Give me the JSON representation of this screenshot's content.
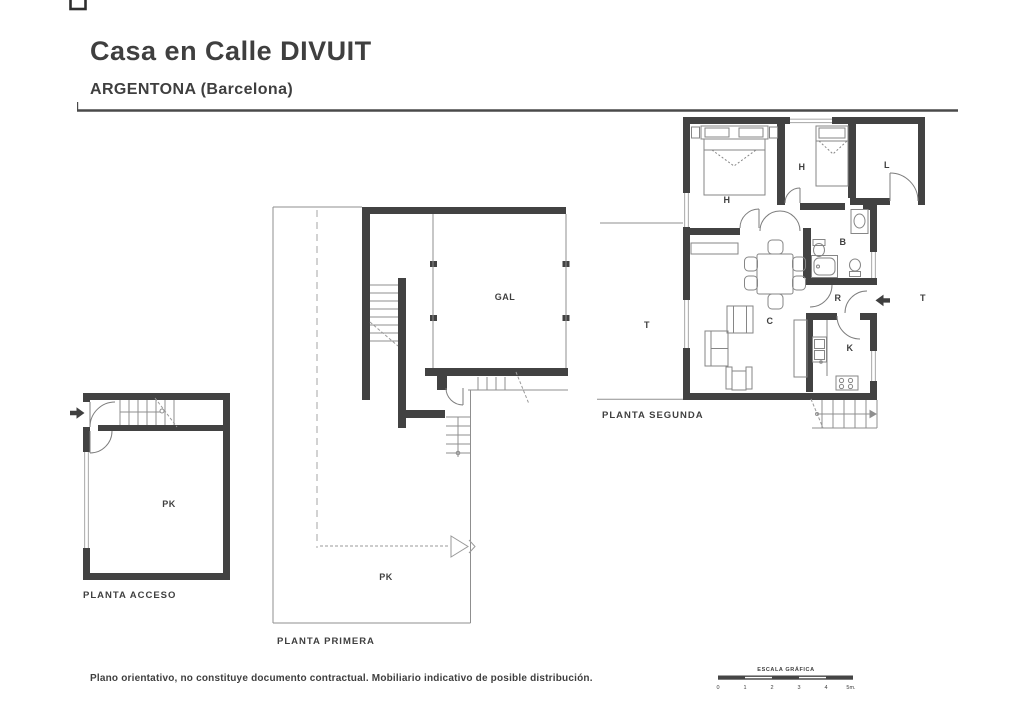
{
  "header": {
    "title": "Casa en Calle DIVUIT",
    "subtitle": "ARGENTONA (Barcelona)"
  },
  "plans": {
    "segunda": {
      "title": "PLANTA SEGUNDA",
      "rooms": {
        "h1": "H",
        "h2": "H",
        "l": "L",
        "b": "B",
        "r": "R",
        "c": "C",
        "k": "K",
        "t_left": "T",
        "t_right": "T"
      }
    },
    "primera": {
      "title": "PLANTA PRIMERA",
      "rooms": {
        "gal": "GAL",
        "pk": "PK"
      }
    },
    "acceso": {
      "title": "PLANTA ACCESO",
      "rooms": {
        "pk": "PK"
      }
    }
  },
  "footer": {
    "disclaimer": "Plano orientativo, no constituye documento contractual. Mobiliario indicativo de posible distribución."
  },
  "scale": {
    "label": "ESCALA GRÁFICA",
    "ticks": [
      "0",
      "1",
      "2",
      "3",
      "4",
      "5m."
    ]
  },
  "colors": {
    "wall": "#424242",
    "text": "#3f3f3f",
    "thin_line": "#8f8f8f"
  }
}
